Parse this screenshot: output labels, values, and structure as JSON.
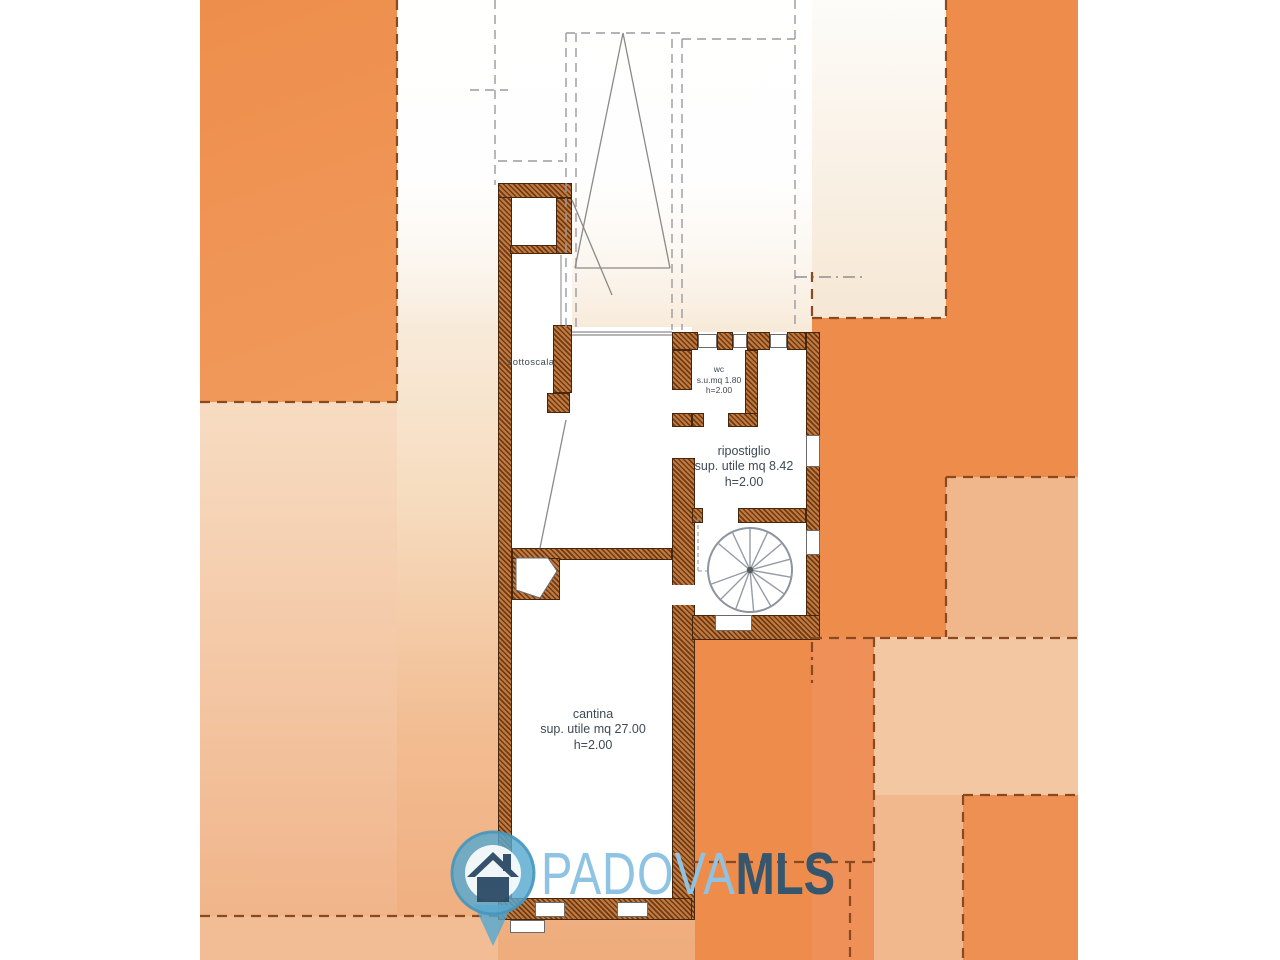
{
  "watermark": {
    "brand_primary": "PADOVA",
    "brand_secondary": "MLS",
    "icon": "house-map-pin-icon"
  },
  "rooms": {
    "sottoscala": {
      "label": "sottoscala"
    },
    "wc": {
      "label": "wc",
      "area": "s.u.mq 1.80",
      "height": "h=2.00"
    },
    "ripostiglio": {
      "label": "ripostiglio",
      "area": "sup. utile mq 8.42",
      "height": "h=2.00"
    },
    "cantina": {
      "label": "cantina",
      "area": "sup. utile mq 27.00",
      "height": "h=2.00"
    }
  },
  "colors": {
    "orange_strong": "#ee8e4e",
    "peach_medium": "#f1b78c",
    "peach_light": "#f3c7a1",
    "cream": "#f7ead9",
    "wall_brown_hatch": "#a05a28",
    "parcel_dashed_brown": "#8a4a20",
    "plan_line_gray": "#8a8a8a",
    "logo_light_blue": "#8fc3e4",
    "logo_navy": "#35566d",
    "pin_teal": "#57a8cf"
  }
}
